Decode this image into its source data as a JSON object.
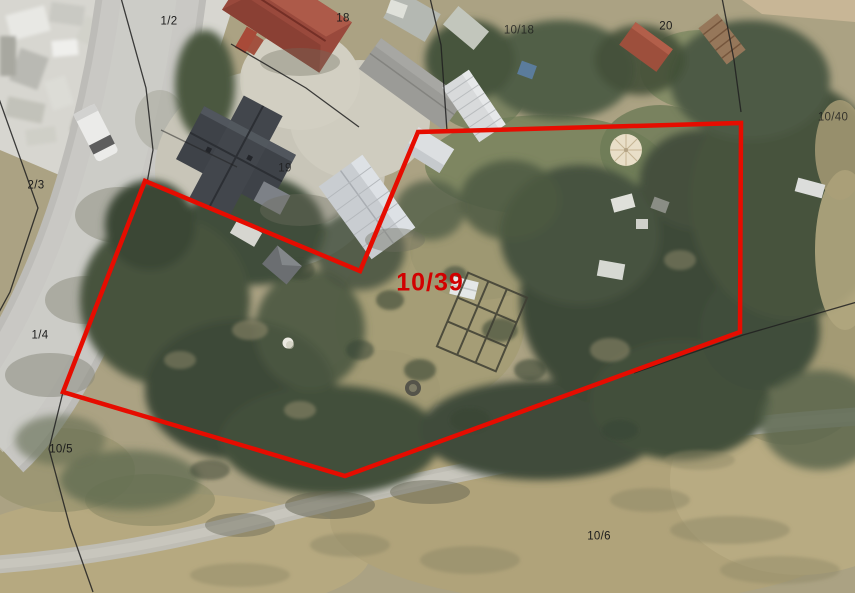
{
  "map": {
    "kind": "aerial-cadastral-map",
    "highlight": {
      "parcel_id": "10/39",
      "outline_color": "#e60c00",
      "label_color": "#d10000",
      "points": "145,181 360,271 418,132 741,123 740,332 345,476 63,392"
    },
    "boundary_color": "#202020",
    "label_color": "#1b1b1b",
    "parcel_labels": [
      {
        "id": "1/2",
        "x": 169,
        "y": 22
      },
      {
        "id": "18",
        "x": 343,
        "y": 19
      },
      {
        "id": "10/18",
        "x": 519,
        "y": 31
      },
      {
        "id": "20",
        "x": 666,
        "y": 27
      },
      {
        "id": "10/40",
        "x": 833,
        "y": 118
      },
      {
        "id": "2/3",
        "x": 36,
        "y": 186
      },
      {
        "id": "19",
        "x": 285,
        "y": 169
      },
      {
        "id": "1/4",
        "x": 40,
        "y": 336
      },
      {
        "id": "10/5",
        "x": 61,
        "y": 450
      },
      {
        "id": "10/6",
        "x": 599,
        "y": 537
      }
    ]
  }
}
